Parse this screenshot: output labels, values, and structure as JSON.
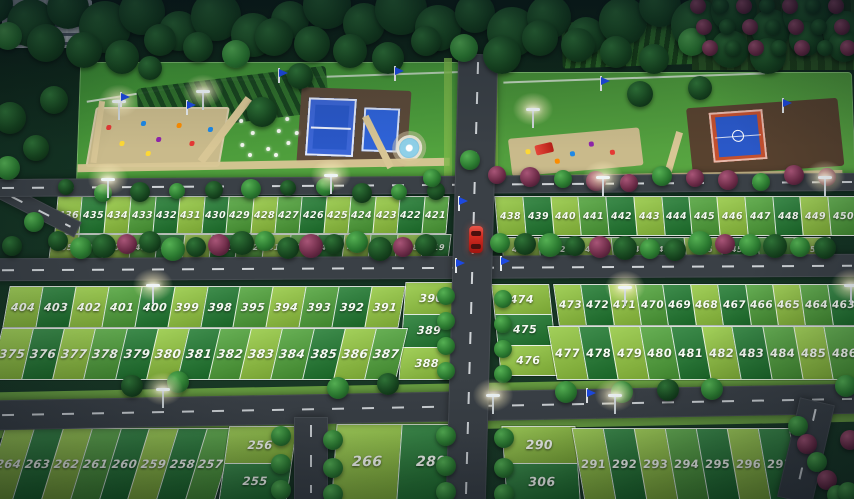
{
  "colors": {
    "plot_light": "#93c83f",
    "plot_mid": "#4ea238",
    "plot_dark": "#1f7a2f",
    "road": "#3a4046",
    "road_marking": "#e9edf0",
    "verge": "#7cb648",
    "court_blue": "#2a58c8",
    "court_blue_light": "#2f63d8",
    "court_red": "#c4502e",
    "path": "#d8c695",
    "sand": "#c9ba8b",
    "tree_green": "#2b7a30",
    "tree_dark": "#17461f",
    "tree_maroon": "#6d2c48",
    "car_red": "#d02a20",
    "flag_blue": "#1d49e0",
    "lamp_glow": "#fff3c4",
    "building": "#b9c2c6",
    "water": "#8fd0e8"
  },
  "car": {
    "color": "#d02a20"
  },
  "blocks": {
    "top_left_row1": [
      "436",
      "435",
      "434",
      "433",
      "432",
      "431",
      "430",
      "429",
      "428",
      "427",
      "426",
      "425",
      "424",
      "423",
      "422",
      "421"
    ],
    "top_left_row2": [
      "405",
      "406",
      "407",
      "408",
      "409",
      "410",
      "411",
      "412",
      "413",
      "414",
      "415",
      "416",
      "417",
      "418",
      "419"
    ],
    "top_right_row1": [
      "438",
      "439",
      "440",
      "441",
      "442",
      "443",
      "444",
      "445",
      "446",
      "447",
      "448",
      "449",
      "450"
    ],
    "top_right_row2": [
      "451",
      "452",
      "453",
      "454",
      "455",
      "456",
      "457",
      "458",
      "459"
    ],
    "mid_left_row1": [
      "404",
      "403",
      "402",
      "401",
      "400",
      "399",
      "398",
      "395",
      "394",
      "393",
      "392",
      "391"
    ],
    "mid_left_col": [
      "390",
      "389",
      "388"
    ],
    "mid_left_row2": [
      "375",
      "376",
      "377",
      "378",
      "379",
      "380",
      "381",
      "382",
      "383",
      "384",
      "385",
      "386",
      "387"
    ],
    "mid_right_col": [
      "474",
      "475",
      "476"
    ],
    "mid_right_row1": [
      "473",
      "472",
      "471",
      "470",
      "469",
      "468",
      "467",
      "466",
      "465",
      "464",
      "463"
    ],
    "mid_right_row2": [
      "477",
      "478",
      "479",
      "480",
      "481",
      "482",
      "483",
      "484",
      "485",
      "486"
    ],
    "bottom_left_row": [
      "264",
      "263",
      "262",
      "261",
      "260",
      "259",
      "258",
      "257"
    ],
    "bottom_left_col": [
      "256",
      "255"
    ],
    "bottom_mid_row": [
      "266",
      "289"
    ],
    "bottom_right_col": [
      "290",
      "306"
    ],
    "bottom_right_row": [
      "291",
      "292",
      "293",
      "294",
      "295",
      "296",
      "297"
    ]
  },
  "amenities": {
    "left_park": [
      "playground",
      "tennis-court",
      "practice-court",
      "flower-beds",
      "fountain",
      "hedge-garden"
    ],
    "right_park": [
      "playground",
      "slide",
      "basketball-court"
    ]
  }
}
